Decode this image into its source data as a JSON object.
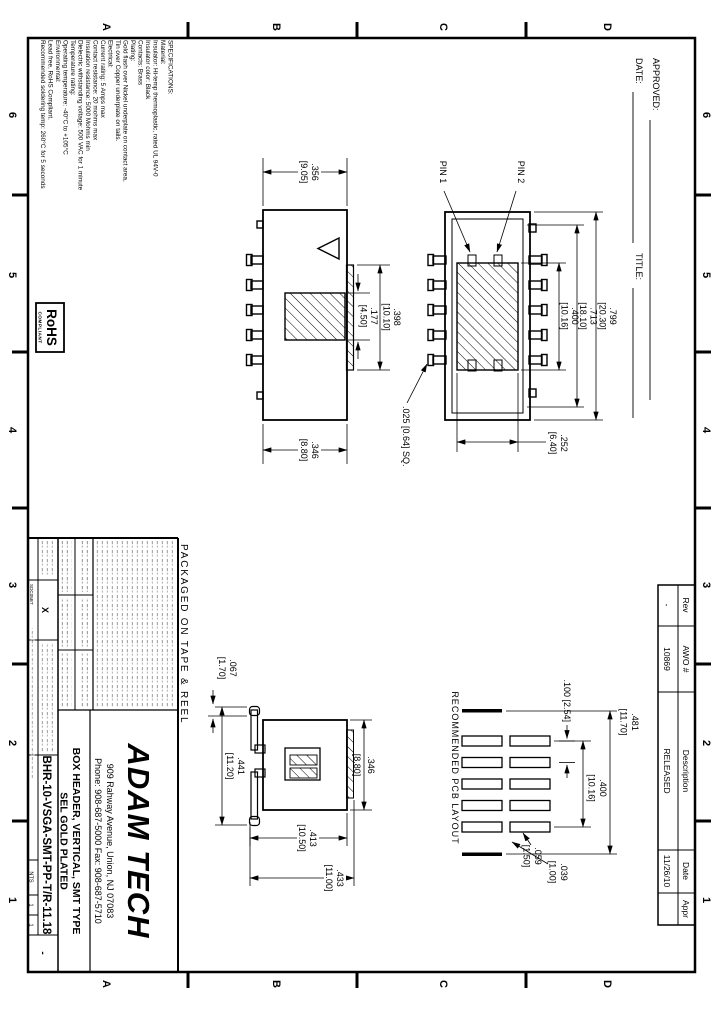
{
  "sheet": {
    "zone_columns": [
      "6",
      "5",
      "4",
      "3",
      "2",
      "1"
    ],
    "zone_rows": [
      "D",
      "C",
      "B",
      "A"
    ],
    "approved_label": "APPROVED:",
    "date_label": "DATE:",
    "title_label": "TITLE:",
    "packaging_note": "PACKAGED ON TAPE & REEL"
  },
  "specs": {
    "lines": [
      "SPECIFICATIONS:",
      "Material:",
      "Insulator: Hi-temp thermoplastic, rated UL 94V-0",
      "Insulator color: Black",
      "Contacts: Brass",
      "Plating:",
      "Gold flash over Nickel underplate on contact area,",
      "Tin over Copper underplate on tails.",
      "Electrical:",
      "Current rating: 5 Amps max",
      "Contact resistance: 20 mohms max",
      "Insulation resistance: 5000 Mohms min",
      "Dielectric withstanding voltage: 500 VAC for 1 minute",
      "Temperature rating:",
      "Operating temperature: -40°C to +105°C",
      "Environmental:",
      "Lead free, RoHS Compliant.",
      "Recommended soldering temp: 260°C for 5 seconds"
    ]
  },
  "rohs_mark": {
    "title": "RoHS",
    "subtitle": "COMPLIANT"
  },
  "plan_view": {
    "pin1_label": "PIN 1",
    "pin2_label": "PIN 2",
    "dim_overall": [
      ".799",
      "[20.30]"
    ],
    "dim_body": [
      ".713",
      "[18.10]"
    ],
    "dim_span": [
      ".400",
      "[10.16]"
    ],
    "dim_slot": [
      ".252",
      "[6.40]"
    ],
    "dim_pin": ".025 [0.64] SQ."
  },
  "side_view": {
    "dim_width_top": [
      ".356",
      "[9.05]"
    ],
    "dim_width_bottom": [
      ".346",
      "[8.80]"
    ],
    "dim_step": [
      ".398",
      "[10.10]"
    ],
    "dim_contact": [
      ".177",
      "[4.50]"
    ]
  },
  "end_view": {
    "dim_body": [
      ".346",
      "[8.80]"
    ],
    "dim_leads": [
      ".441",
      "[11.20]"
    ],
    "dim_foot": [
      ".067",
      "[1.70]"
    ],
    "dim_height": [
      ".413",
      "[10.50]"
    ],
    "dim_total": [
      ".433",
      "[11.00]"
    ]
  },
  "pcb_layout": {
    "title": "RECOMMENDED PCB LAYOUT",
    "dim_outer": [
      ".481",
      "[11.70]"
    ],
    "dim_span": [
      ".400",
      "[10.16]"
    ],
    "dim_pitch": ".100 [2.54]",
    "dim_pad_width": [
      ".059",
      "[1.50]"
    ],
    "dim_gap": [
      ".039",
      "[1.00]"
    ]
  },
  "title_block": {
    "company": "ADAM TECH",
    "address": "909 Rahway Avenue, Union, NJ 07083",
    "phone_fax": "Phone: 908-687-5000 Fax: 908-687-5710",
    "product_title": "BOX HEADER, VERTICAL, SMT TYPE",
    "product_subtitle": "SEL GOLD PLATED",
    "part_number": "BHR-10-VSGA-SMT-PP-T/R-11.18",
    "tolerance_mark": "X",
    "cad_code": "SDC05BT",
    "scale": "NTS",
    "sheet_num_1": "1",
    "sheet_num_2": "1",
    "rev": "-"
  },
  "revision_table": {
    "headers": [
      "Rev",
      "AWO #",
      "Description",
      "Date",
      "Appr"
    ],
    "row": [
      "-",
      "10869",
      "RELEASED",
      "11/26/10",
      ""
    ]
  }
}
